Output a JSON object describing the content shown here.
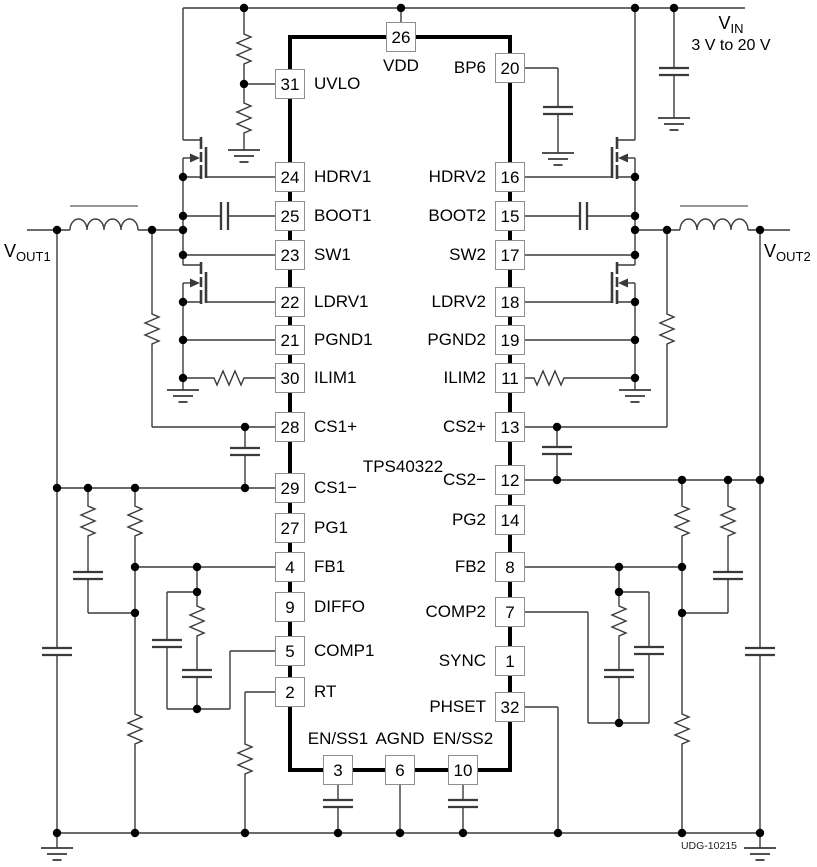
{
  "diagram": {
    "ic_label": "TPS40322",
    "doc_id": "UDG-10215",
    "vin": {
      "symbol": "V",
      "subscript": "IN",
      "range": "3 V to 20 V"
    },
    "vout1": {
      "symbol": "V",
      "subscript": "OUT1"
    },
    "vout2": {
      "symbol": "V",
      "subscript": "OUT2"
    }
  },
  "colors": {
    "background": "#ffffff",
    "wire": "#3a3a3a",
    "ic_outline": "#000000",
    "pin_box_border": "#8f8f8f",
    "dot": "#000000",
    "text": "#000000"
  },
  "pins": [
    {
      "number": "26",
      "name": "VDD",
      "x": 401,
      "y": 37,
      "side": "top"
    },
    {
      "number": "31",
      "name": "UVLO",
      "x": 290,
      "y": 84,
      "side": "left"
    },
    {
      "number": "24",
      "name": "HDRV1",
      "x": 290,
      "y": 177,
      "side": "left"
    },
    {
      "number": "25",
      "name": "BOOT1",
      "x": 290,
      "y": 216,
      "side": "left"
    },
    {
      "number": "23",
      "name": "SW1",
      "x": 290,
      "y": 255,
      "side": "left"
    },
    {
      "number": "22",
      "name": "LDRV1",
      "x": 290,
      "y": 302,
      "side": "left"
    },
    {
      "number": "21",
      "name": "PGND1",
      "x": 290,
      "y": 340,
      "side": "left"
    },
    {
      "number": "30",
      "name": "ILIM1",
      "x": 290,
      "y": 378,
      "side": "left"
    },
    {
      "number": "28",
      "name": "CS1+",
      "x": 290,
      "y": 427,
      "side": "left"
    },
    {
      "number": "29",
      "name": "CS1−",
      "x": 290,
      "y": 488,
      "side": "left"
    },
    {
      "number": "27",
      "name": "PG1",
      "x": 290,
      "y": 528,
      "side": "left"
    },
    {
      "number": "4",
      "name": "FB1",
      "x": 290,
      "y": 567,
      "side": "left"
    },
    {
      "number": "9",
      "name": "DIFFO",
      "x": 290,
      "y": 607,
      "side": "left"
    },
    {
      "number": "5",
      "name": "COMP1",
      "x": 290,
      "y": 651,
      "side": "left"
    },
    {
      "number": "2",
      "name": "RT",
      "x": 290,
      "y": 692,
      "side": "left"
    },
    {
      "number": "3",
      "name": "EN/SS1",
      "x": 338,
      "y": 770,
      "side": "bottom"
    },
    {
      "number": "6",
      "name": "AGND",
      "x": 400,
      "y": 770,
      "side": "bottom"
    },
    {
      "number": "10",
      "name": "EN/SS2",
      "x": 463,
      "y": 770,
      "side": "bottom"
    },
    {
      "number": "20",
      "name": "BP6",
      "x": 510,
      "y": 68,
      "side": "right"
    },
    {
      "number": "16",
      "name": "HDRV2",
      "x": 510,
      "y": 177,
      "side": "right"
    },
    {
      "number": "15",
      "name": "BOOT2",
      "x": 510,
      "y": 216,
      "side": "right"
    },
    {
      "number": "17",
      "name": "SW2",
      "x": 510,
      "y": 255,
      "side": "right"
    },
    {
      "number": "18",
      "name": "LDRV2",
      "x": 510,
      "y": 302,
      "side": "right"
    },
    {
      "number": "19",
      "name": "PGND2",
      "x": 510,
      "y": 340,
      "side": "right"
    },
    {
      "number": "11",
      "name": "ILIM2",
      "x": 510,
      "y": 378,
      "side": "right"
    },
    {
      "number": "13",
      "name": "CS2+",
      "x": 510,
      "y": 427,
      "side": "right"
    },
    {
      "number": "12",
      "name": "CS2−",
      "x": 510,
      "y": 480,
      "side": "right"
    },
    {
      "number": "14",
      "name": "PG2",
      "x": 510,
      "y": 520,
      "side": "right"
    },
    {
      "number": "8",
      "name": "FB2",
      "x": 510,
      "y": 567,
      "side": "right"
    },
    {
      "number": "7",
      "name": "COMP2",
      "x": 510,
      "y": 612,
      "side": "right"
    },
    {
      "number": "1",
      "name": "SYNC",
      "x": 510,
      "y": 661,
      "side": "right"
    },
    {
      "number": "32",
      "name": "PHSET",
      "x": 510,
      "y": 707,
      "side": "right"
    }
  ]
}
